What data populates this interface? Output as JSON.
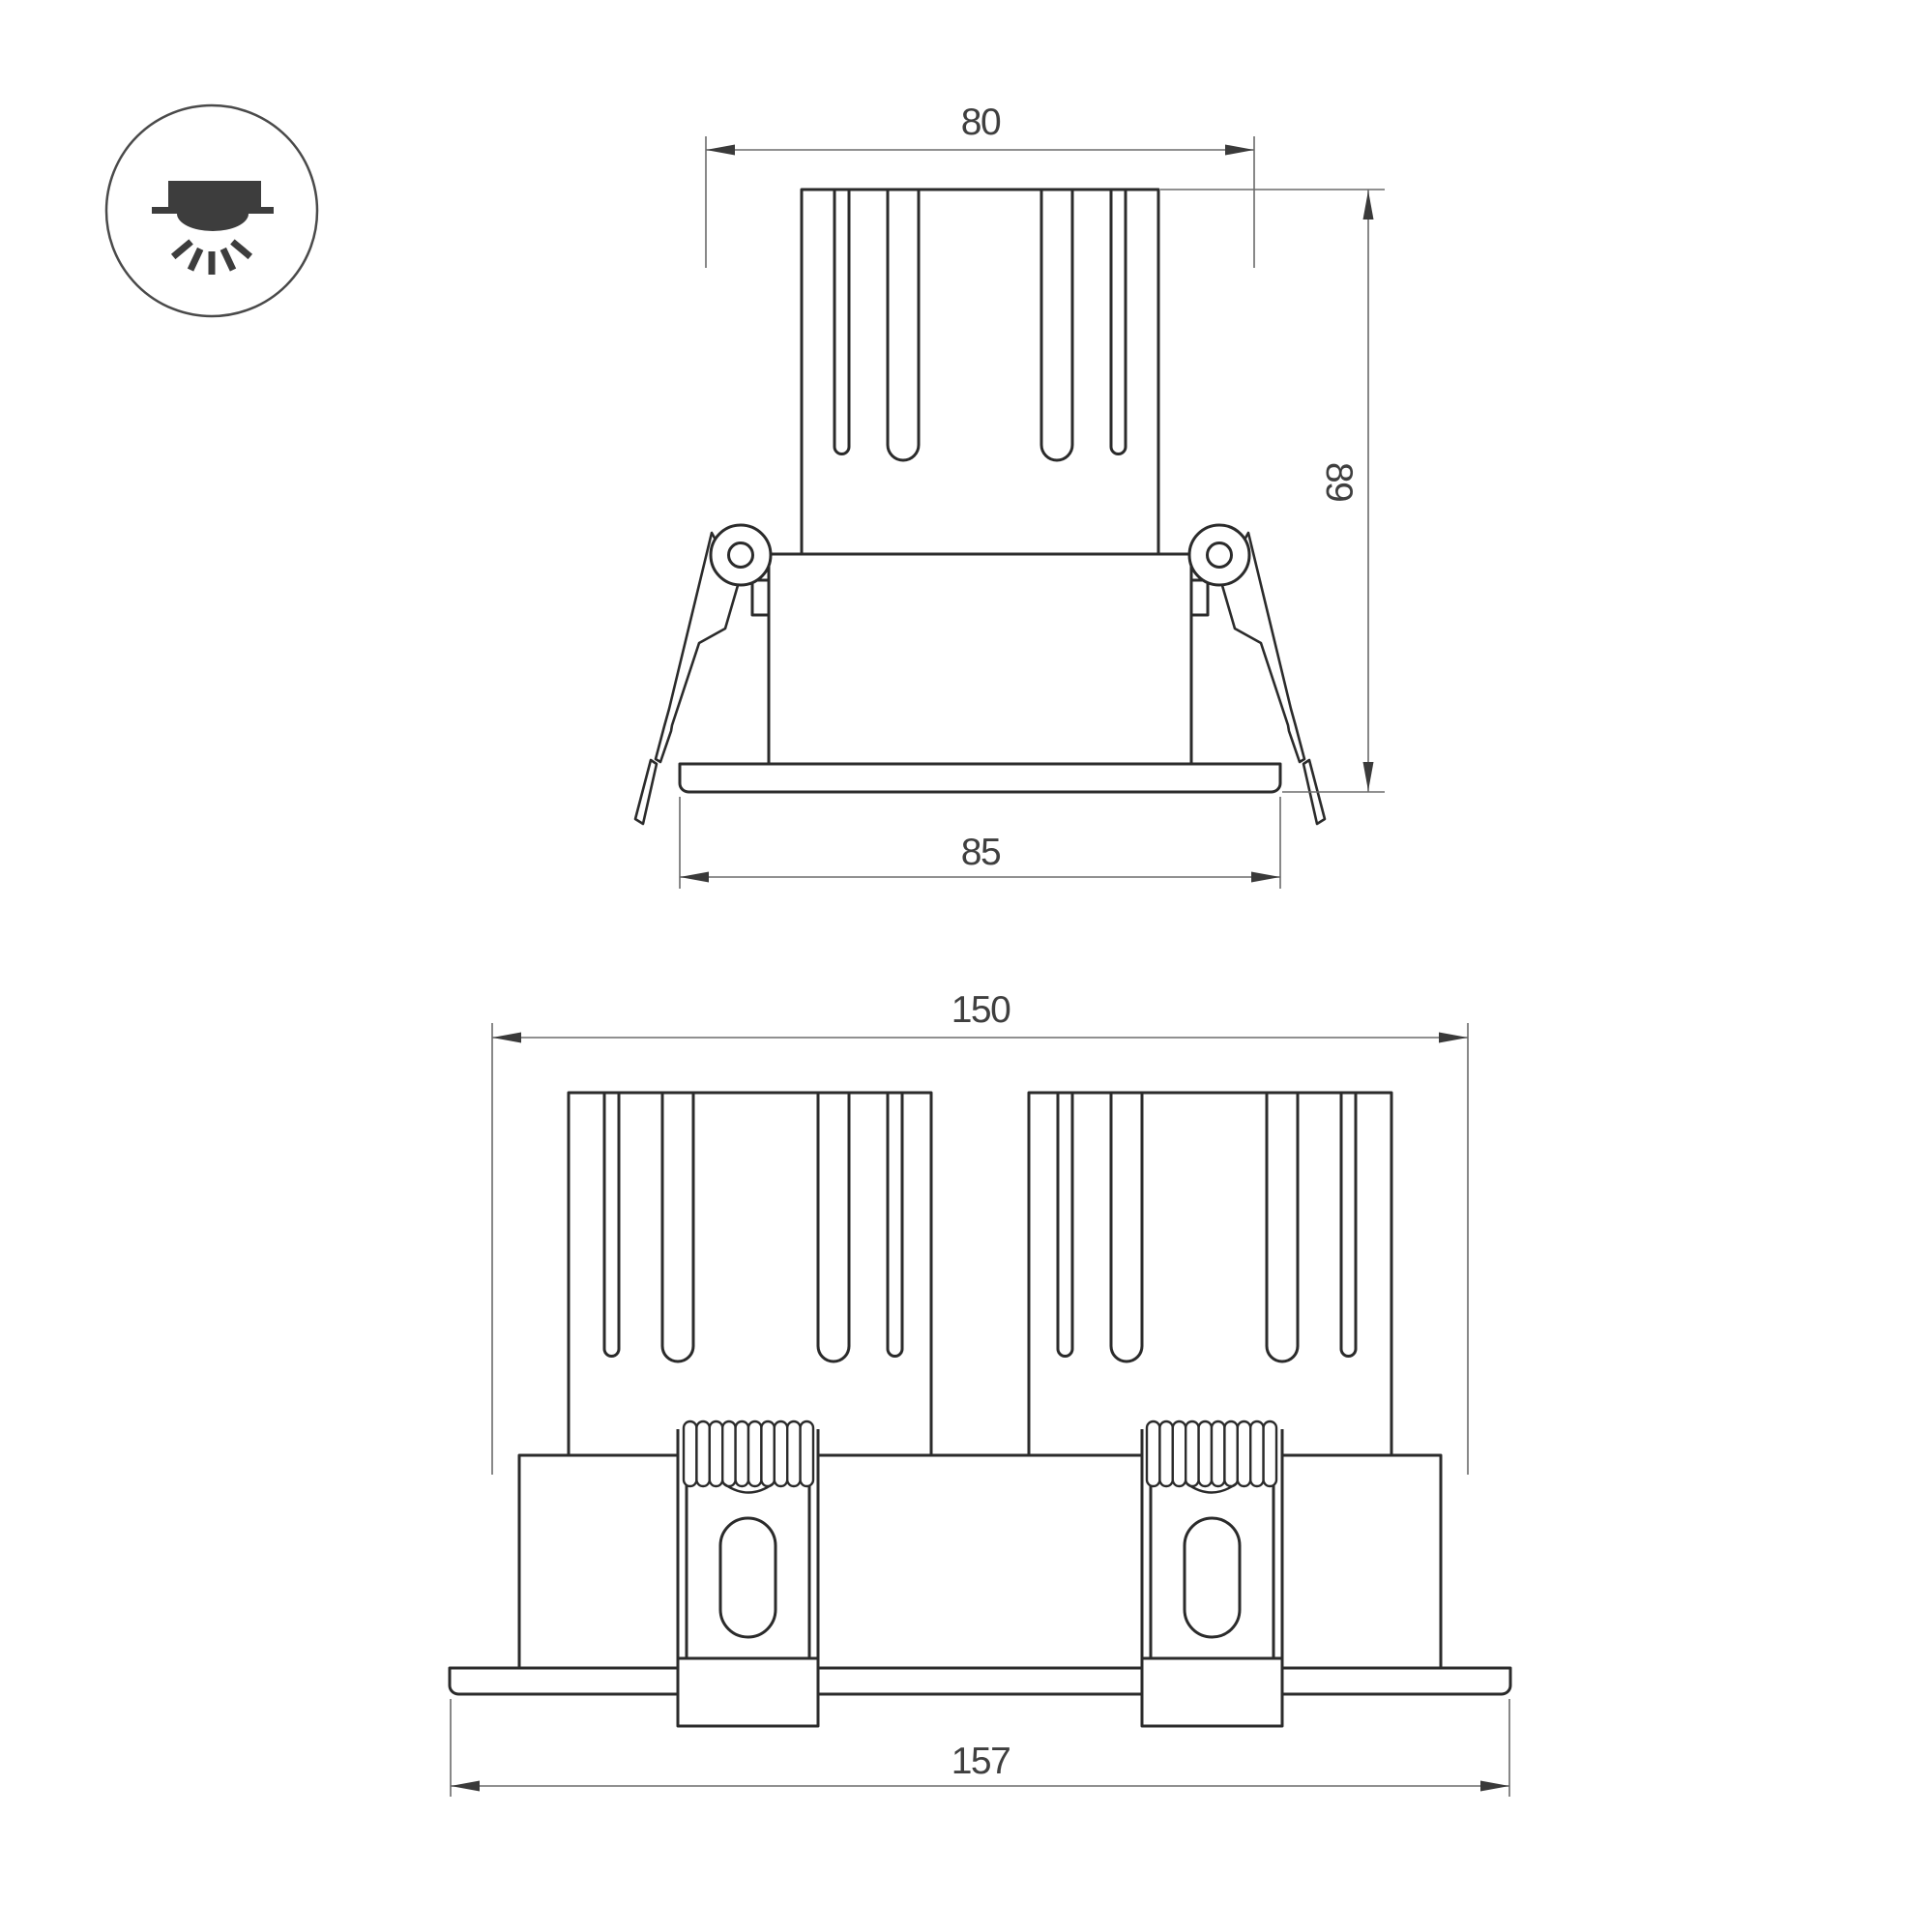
{
  "page": {
    "background": "#ffffff"
  },
  "colors": {
    "outline": "#2b2b2b",
    "dim_line": "#6b6b6b",
    "arrow": "#3a3a3a",
    "text": "#3f3f3f",
    "icon": "#3d3d3d",
    "icon_circle": "#4a4a4a"
  },
  "icon": {
    "name": "recessed-downlight-icon"
  },
  "side_view": {
    "label": "single-module-side-view",
    "dims": {
      "top_width": "80",
      "height": "89",
      "flange_width": "85"
    }
  },
  "front_view": {
    "label": "twin-module-front-view",
    "dims": {
      "overall_width": "150",
      "flange_width": "157"
    }
  }
}
